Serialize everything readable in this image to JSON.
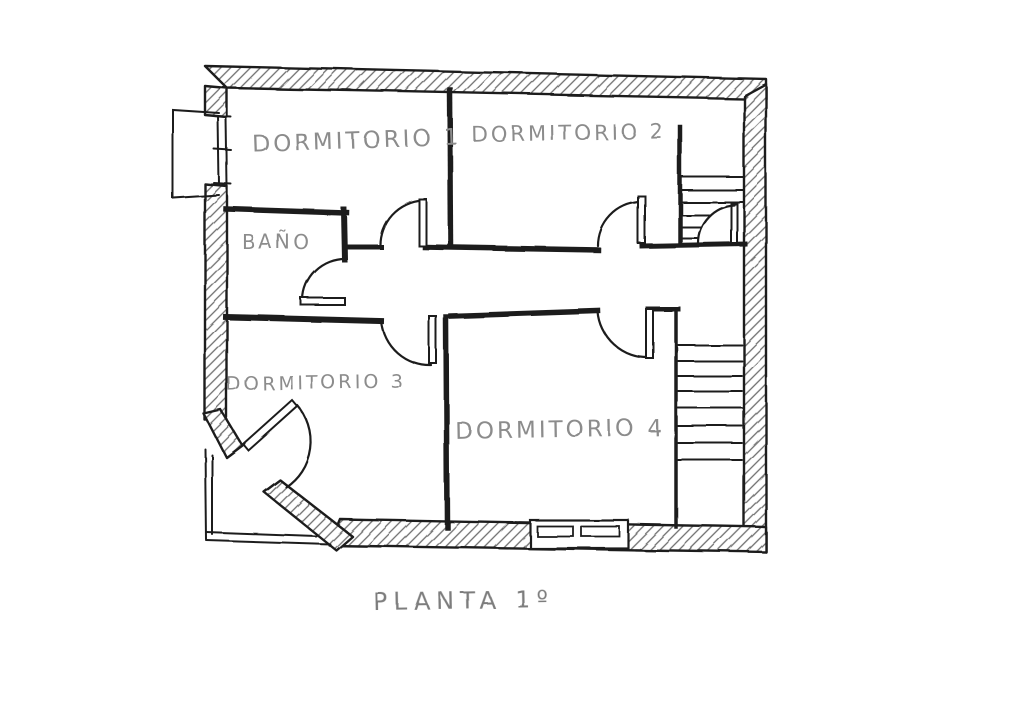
{
  "title": {
    "label": "PLANTA 1º"
  },
  "rooms": [
    {
      "name": "dormitorio-1",
      "label": "DORMITORIO 1"
    },
    {
      "name": "dormitorio-2",
      "label": "DORMITORIO 2"
    },
    {
      "name": "bano",
      "label": "BAÑO"
    },
    {
      "name": "dormitorio-3",
      "label": "DORMITORIO 3"
    },
    {
      "name": "dormitorio-4",
      "label": "DORMITORIO 4"
    }
  ],
  "elements": {
    "staircases": [
      "upper-right-staircase",
      "lower-right-staircase"
    ],
    "doors": [
      "dormitorio-1-door",
      "dormitorio-2-door",
      "dormitorio-3-door",
      "dormitorio-4-door",
      "bano-door",
      "entrance-door",
      "stair-door"
    ],
    "windows": [
      "left-wall-window",
      "bottom-wall-window"
    ],
    "balcony": "left-balcony"
  },
  "colors": {
    "ink": "#1f1f1f",
    "hatch": "#6e6e6e",
    "pencil_text": "#8c8c8c",
    "paper": "#ffffff"
  }
}
